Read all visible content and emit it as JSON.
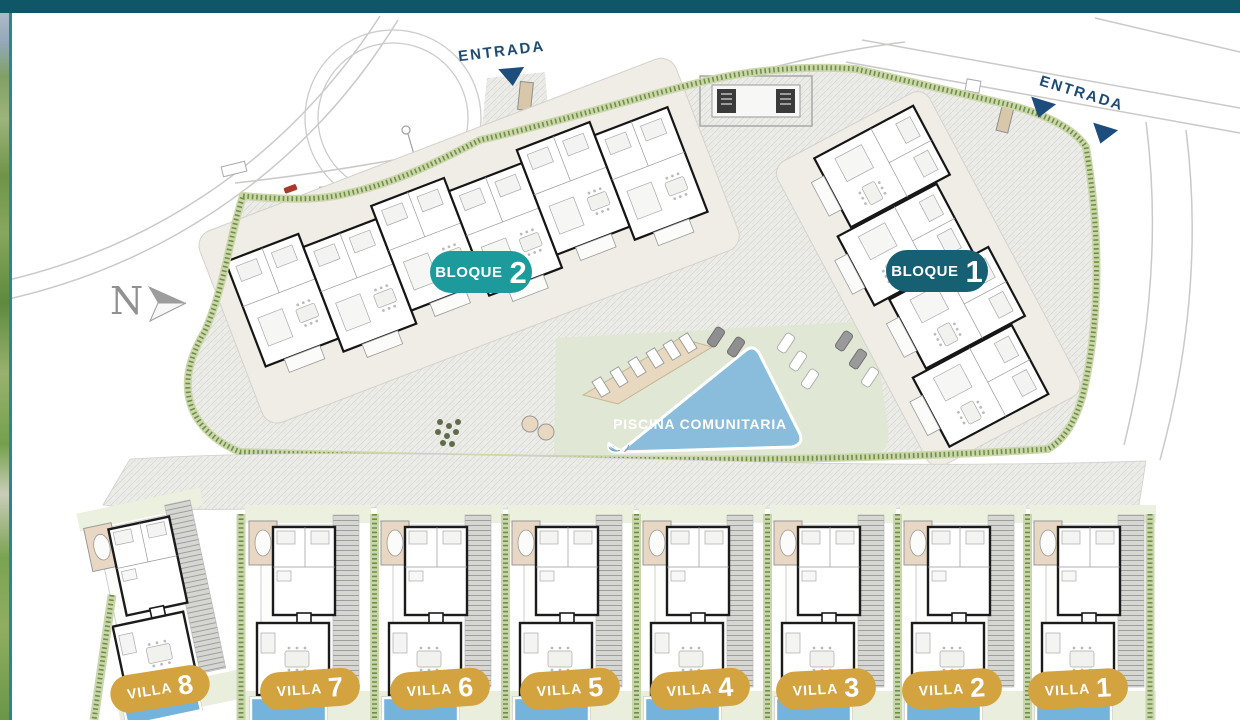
{
  "north": {
    "label": "N"
  },
  "entrances": [
    {
      "label": "ENTRADA"
    },
    {
      "label": "ENTRADA"
    }
  ],
  "blocks": [
    {
      "label": "BLOQUE",
      "number": "2",
      "color": "#1d9b9c"
    },
    {
      "label": "BLOQUE",
      "number": "1",
      "color": "#175f73"
    }
  ],
  "pool": {
    "label": "PISCINA COMUNITARIA",
    "color": "#8abcdb"
  },
  "villas": [
    {
      "label": "VILLA",
      "number": "8"
    },
    {
      "label": "VILLA",
      "number": "7"
    },
    {
      "label": "VILLA",
      "number": "6"
    },
    {
      "label": "VILLA",
      "number": "5"
    },
    {
      "label": "VILLA",
      "number": "4"
    },
    {
      "label": "VILLA",
      "number": "3"
    },
    {
      "label": "VILLA",
      "number": "2"
    },
    {
      "label": "VILLA",
      "number": "1"
    }
  ],
  "colors": {
    "top_bar": "#0f5666",
    "side_line": "#2e8494",
    "entrance_navy": "#1d4b76",
    "villa_gold": "#d2a33f",
    "pool_blue": "#8abcdb",
    "villa_pool_blue": "#74b4dc",
    "hedge_green": "#6f8f48",
    "paving_grey": "#ecece8"
  }
}
